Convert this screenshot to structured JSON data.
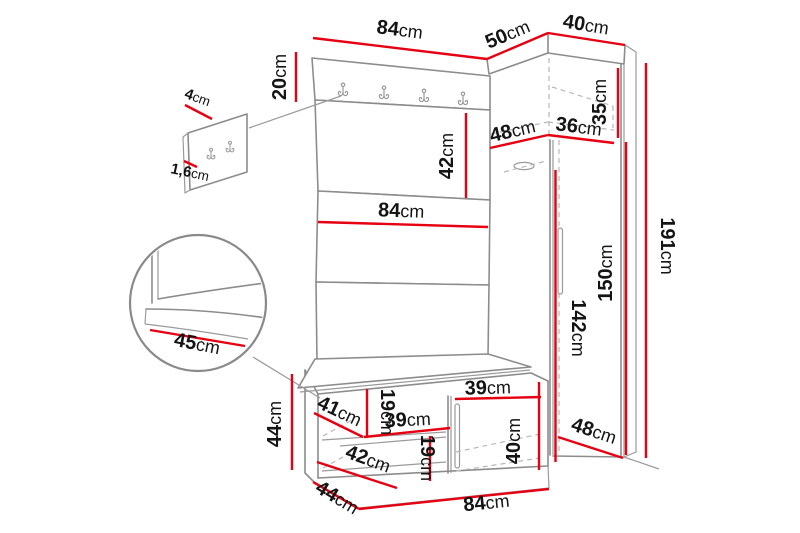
{
  "colors": {
    "dimension_line": "#e60011",
    "outline": "#8c8c8c",
    "hidden_line": "#b8b8b8",
    "text": "#141414",
    "background": "#ffffff"
  },
  "hooks": {
    "main_panel_count": 4,
    "detail_panel_count": 2
  },
  "dims": {
    "panel_top_width": {
      "value": "84",
      "unit": "cm"
    },
    "corner_top_depth": {
      "value": "50",
      "unit": "cm"
    },
    "wardrobe_top_width": {
      "value": "40",
      "unit": "cm"
    },
    "hook_board_height": {
      "value": "20",
      "unit": "cm"
    },
    "hook_detail_height": {
      "value": "4",
      "unit": "cm"
    },
    "hook_panel_thickness": {
      "value": "1,6",
      "unit": "cm"
    },
    "panel_section_height": {
      "value": "42",
      "unit": "cm"
    },
    "panel_mid_width": {
      "value": "84",
      "unit": "cm"
    },
    "top_shelf_depth": {
      "value": "48",
      "unit": "cm"
    },
    "top_shelf_width": {
      "value": "36",
      "unit": "cm"
    },
    "top_compartment_height": {
      "value": "35",
      "unit": "cm"
    },
    "wardrobe_inner_height": {
      "value": "142",
      "unit": "cm"
    },
    "wardrobe_door_height": {
      "value": "150",
      "unit": "cm"
    },
    "wardrobe_total_height": {
      "value": "191",
      "unit": "cm"
    },
    "seat_detail_depth": {
      "value": "45",
      "unit": "cm"
    },
    "bench_height": {
      "value": "44",
      "unit": "cm"
    },
    "bench_shelf_depth": {
      "value": "41",
      "unit": "cm"
    },
    "bench_gap_upper": {
      "value": "19",
      "unit": "cm"
    },
    "bench_shelf_width": {
      "value": "39",
      "unit": "cm"
    },
    "bench_opening_width": {
      "value": "39",
      "unit": "cm"
    },
    "bench_opening_height": {
      "value": "40",
      "unit": "cm"
    },
    "bench_lower_depth": {
      "value": "42",
      "unit": "cm"
    },
    "bench_gap_lower": {
      "value": "19",
      "unit": "cm"
    },
    "bench_depth": {
      "value": "44",
      "unit": "cm"
    },
    "bench_width": {
      "value": "84",
      "unit": "cm"
    },
    "wardrobe_bottom_depth": {
      "value": "48",
      "unit": "cm"
    }
  }
}
